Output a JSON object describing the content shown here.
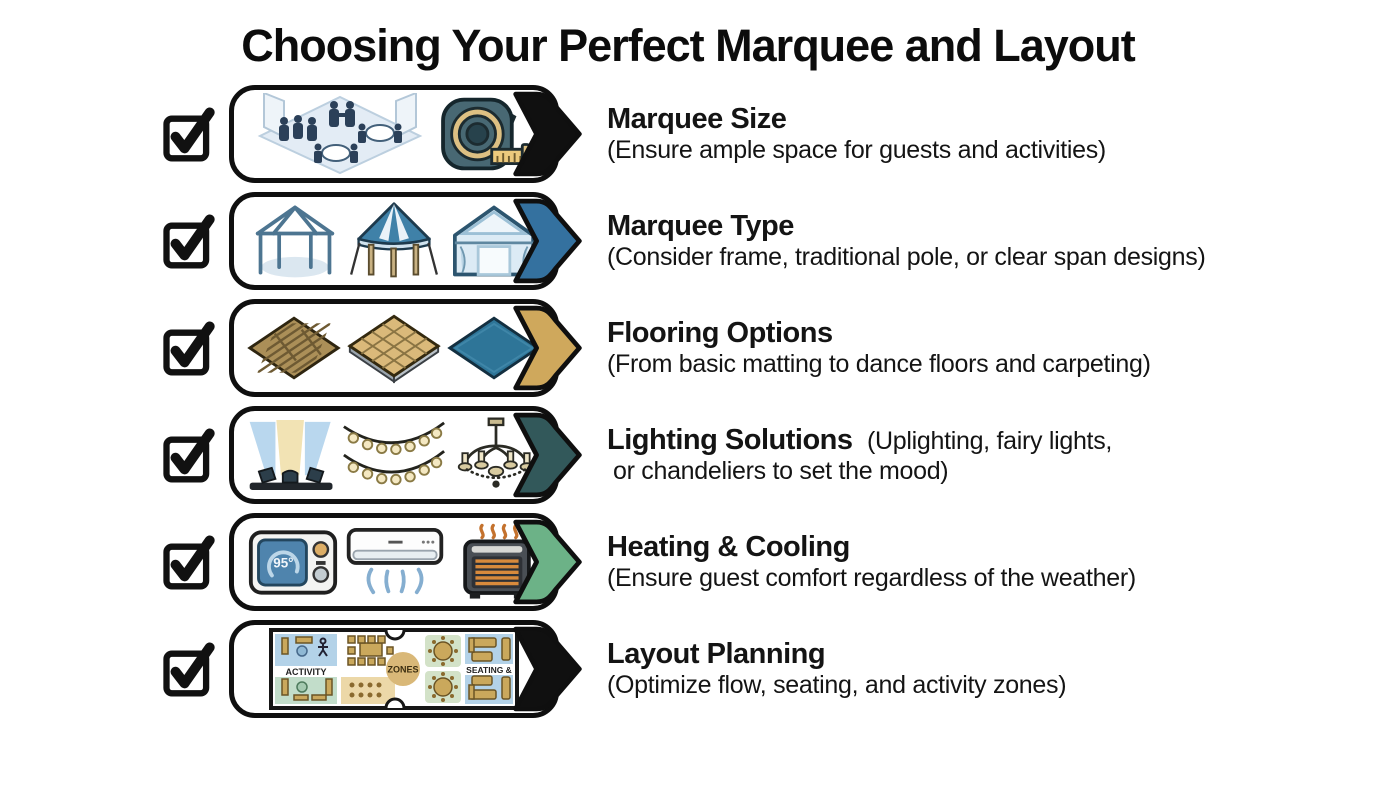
{
  "title": "Choosing Your Perfect Marquee and Layout",
  "rows": [
    {
      "title": "Marquee Size",
      "desc": "(Ensure ample space for guests and activities)",
      "arrow_color": "#101010",
      "icons": [
        "guests-floorplan-icon",
        "tape-measure-icon"
      ]
    },
    {
      "title": "Marquee Type",
      "desc": "(Consider frame, traditional pole, or clear span designs)",
      "arrow_color": "#34719f",
      "icons": [
        "frame-marquee-icon",
        "pole-tent-icon",
        "clear-span-tent-icon"
      ]
    },
    {
      "title": "Flooring Options",
      "desc": "(From basic matting to dance floors and carpeting)",
      "arrow_color": "#cfa85c",
      "icons": [
        "wood-matting-icon",
        "dance-floor-icon",
        "carpet-icon"
      ]
    },
    {
      "title": "Lighting Solutions",
      "desc_inline": "(Uplighting, fairy lights,",
      "desc_line2": "or chandeliers to set the mood)",
      "arrow_color": "#32585a",
      "icons": [
        "uplighting-icon",
        "fairy-lights-icon",
        "chandelier-icon"
      ]
    },
    {
      "title": "Heating & Cooling",
      "desc": "(Ensure guest comfort regardless of the weather)",
      "arrow_color": "#6cb287",
      "icons": [
        "thermostat-icon",
        "air-conditioner-icon",
        "space-heater-icon"
      ]
    },
    {
      "title": "Layout Planning",
      "desc": "(Optimize flow, seating, and activity zones)",
      "arrow_color": "#101010",
      "icons": [
        "floor-plan-icon"
      ]
    }
  ],
  "thermostat": {
    "display": "95°"
  },
  "floor_plan": {
    "labels": {
      "activity": "ACTIVITY",
      "zones": "ZONES",
      "seating": "SEATING &"
    }
  },
  "colors": {
    "checkbox": "#111111",
    "panel_border": "#0f0f0f",
    "scene_blue": "#e3ecf5",
    "tape_gold": "#ddc083",
    "tent_blue": "#3f81a8",
    "floor_wood": "#ab8f58",
    "floor_tile": "#dab97a",
    "floor_carpet": "#2e7598",
    "heater_coil": "#d88a3c"
  }
}
